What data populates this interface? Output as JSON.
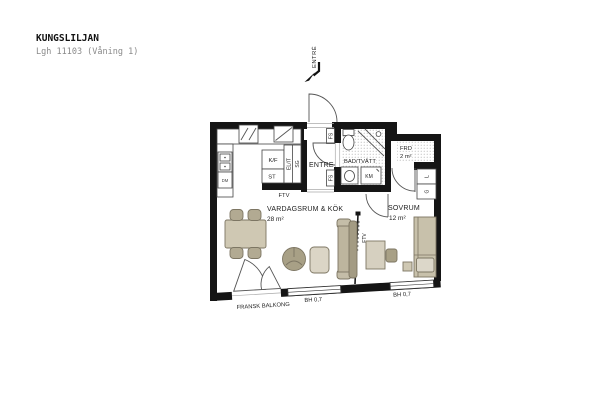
{
  "header": {
    "title": "KUNGSLILJAN",
    "subtitle": "Lgh 11103 (Våning 1)"
  },
  "entry": {
    "label": "ENTRÉ"
  },
  "rooms": {
    "living": {
      "name": "VARDAGSRUM & KÖK",
      "area": "28 m²"
    },
    "bedroom": {
      "name": "SOVRUM",
      "area": "12 m²"
    },
    "bathroom": {
      "name": "BAD/TVÄTT"
    },
    "hall": {
      "name": "ENTRE"
    },
    "storage": {
      "name": "FRD",
      "area": "2 m²"
    }
  },
  "labels": {
    "fridge_freezer": "K/F",
    "cleaning_closet": "ST",
    "electrical_it": "EL/IT",
    "sliding_wardrobe": "SG",
    "tv_outlet_kitchen": "FTV",
    "tv_outlet_living": "FTV",
    "tv_outlet_bedroom": "FTV",
    "shaft_top": "FS",
    "shaft_bottom": "FS",
    "washing_machine": "KM",
    "dishwasher": "DM",
    "linen_closet": "L",
    "wardrobe": "G",
    "window_living": "BH 0,7",
    "window_bedroom": "BH 0,7",
    "french_balcony": "FRANSK BALKONG"
  },
  "colors": {
    "wall": "#151515",
    "furniture_beige": "#c9c2ac",
    "floor_dots": "#8f8f8f"
  }
}
